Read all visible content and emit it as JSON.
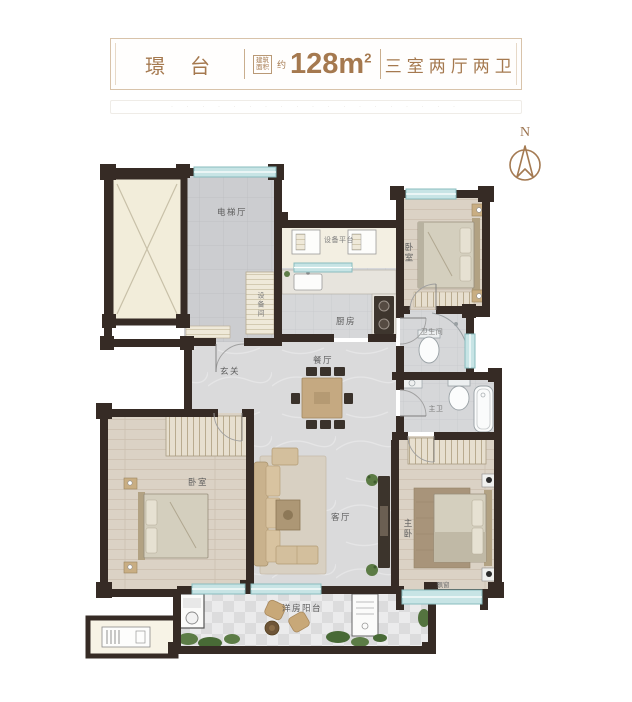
{
  "header": {
    "name": "璟 台",
    "area_box_line1": "建筑",
    "area_box_line2": "面积",
    "area_prefix": "约",
    "area_value": "128m",
    "area_sup": "2",
    "layout_type": "三室两厅两卫"
  },
  "watermark": {
    "text": "· · · · · · · · ·   · · ·   · · · · · · ·"
  },
  "compass": {
    "label": "N"
  },
  "rooms": {
    "elevator_hall": {
      "label": "电梯厅"
    },
    "equipment_platform": {
      "label": "设备平台"
    },
    "equipment_room": {
      "label": "设备间"
    },
    "kitchen": {
      "label": "厨房"
    },
    "bedroom_north": {
      "label": "卧室"
    },
    "bathroom": {
      "label": "卫生间"
    },
    "foyer": {
      "label": "玄关"
    },
    "dining": {
      "label": "餐厅"
    },
    "master_bath": {
      "label": "主卫"
    },
    "bedroom_west": {
      "label": "卧室"
    },
    "living": {
      "label": "客厅"
    },
    "master_bedroom": {
      "label": "主卧"
    },
    "bay_window": {
      "label": "飘窗"
    },
    "balcony": {
      "label": "洋房阳台"
    }
  },
  "colors": {
    "accent_brown": "#a5794f",
    "wall_dark": "#362b25",
    "window_teal": "#c7e4e5",
    "wood_floor": "#dbd2c5",
    "marble_floor": "#dadadb"
  }
}
